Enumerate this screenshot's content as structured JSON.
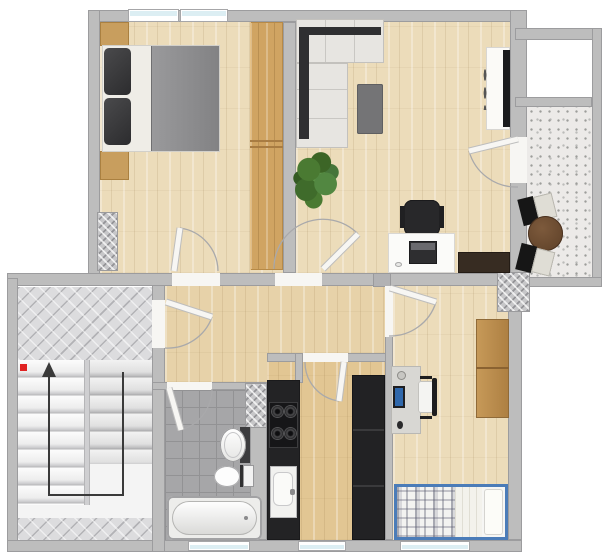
{
  "title": "apartment-floor-plan",
  "colors": {
    "bg": "#ffffff",
    "wall": "#bdbdbd",
    "wall_edge": "#9c9c9e",
    "wood": "#ecdcba",
    "wood_hall": "#e7d2a9",
    "wood_kitchen": "#e2c693",
    "closet": "#d0a462",
    "tile": "#a6a6a8",
    "tile_line": "#929294",
    "herring": "#dcdcde",
    "balcony": "#eceae8",
    "counter_black": "#232325",
    "sofa": "#e7e5e1",
    "sofa_back": "#2f2f31",
    "coffee_table": "#747476",
    "sideboard_brown": "#372c22",
    "bed_blanket": "#8e8e90",
    "pillow_dark": "#3a3a3c",
    "plant_green": "#4a7a32",
    "bed_frame_blue": "#4b7cb8",
    "wardrobe_brown": "#bd8c4d",
    "round_table_brown": "#6b4a2e",
    "chair_black": "#161616",
    "chair_cushion": "#dfddd5",
    "stair_arrow": "#3a3a3a",
    "red_marker": "#e02222",
    "glass": "#dceef3",
    "leaf": "#f7f6f3",
    "arc": "#a9a9ab"
  },
  "plan": {
    "type": "apartment-floor-plan-top-view",
    "rooms": [
      {
        "name": "bedroom",
        "features": [
          "double-bed",
          "dark-pillows",
          "gray-blanket",
          "nightstand-top",
          "nightstand-bottom",
          "built-in-wardrobe",
          "chimney-shaft",
          "two-windows"
        ]
      },
      {
        "name": "living-room",
        "features": [
          "corner-sofa",
          "coffee-table",
          "potted-plant",
          "desk-with-laptop",
          "office-chair",
          "dark-sideboard",
          "tv-lowboard",
          "balcony-door"
        ]
      },
      {
        "name": "balcony",
        "features": [
          "speckled-stone-floor",
          "two-folding-chairs",
          "round-table"
        ]
      },
      {
        "name": "hallway",
        "features": [
          "entrance-door",
          "doors-to-all-rooms"
        ]
      },
      {
        "name": "staircase",
        "features": [
          "upper-landing",
          "two-flights",
          "direction-arrow-up",
          "red-marker",
          "lower-landing"
        ]
      },
      {
        "name": "bathroom",
        "features": [
          "washbasin",
          "toilet",
          "bathtub",
          "gray-tile-floor",
          "window"
        ]
      },
      {
        "name": "kitchen",
        "features": [
          "gas-stove-4-burners",
          "sink",
          "black-counter",
          "tall-black-unit",
          "window"
        ]
      },
      {
        "name": "small-room",
        "features": [
          "desk-with-monitor",
          "desk-chair",
          "wardrobe",
          "single-bed-blue-frame-plaid",
          "window"
        ]
      }
    ],
    "door_count": 7,
    "window_count": 5
  }
}
